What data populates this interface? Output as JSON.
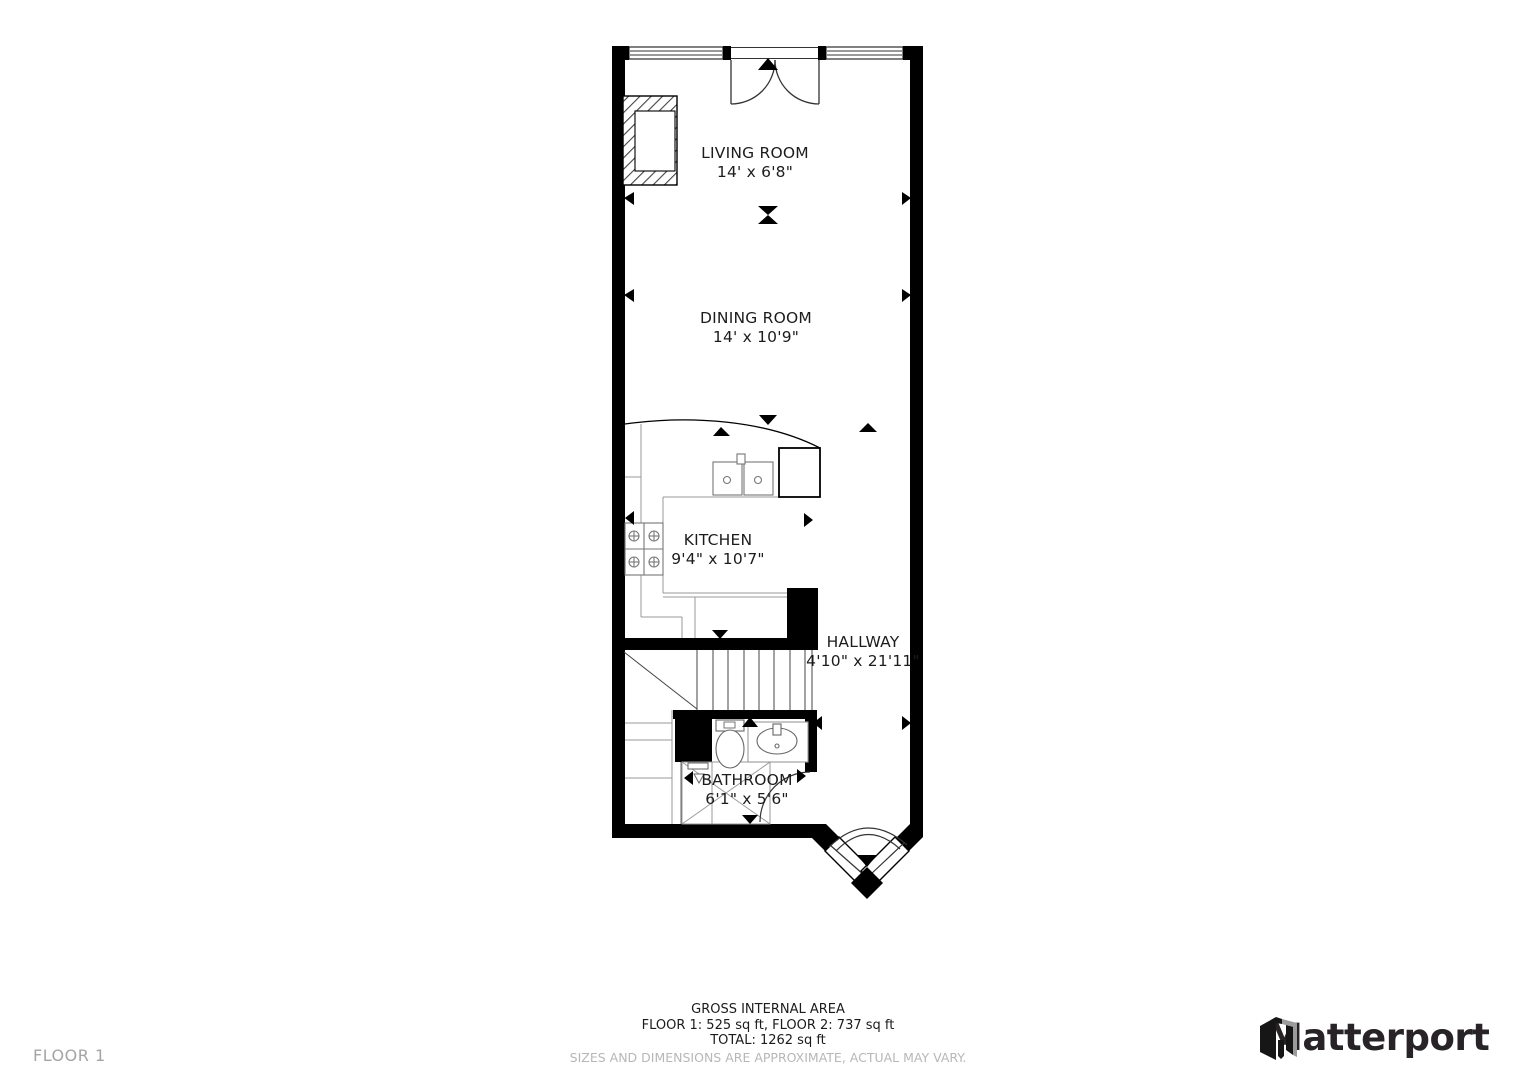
{
  "floorplan": {
    "rooms": [
      {
        "name": "LIVING ROOM",
        "dims": "14' x 6'8\""
      },
      {
        "name": "DINING ROOM",
        "dims": "14' x 10'9\""
      },
      {
        "name": "KITCHEN",
        "dims": "9'4\" x 10'7\""
      },
      {
        "name": "HALLWAY",
        "dims": "4'10\" x 21'11\""
      },
      {
        "name": "BATHROOM",
        "dims": "6'1\" x 5'6\""
      }
    ]
  },
  "footer": {
    "area_title": "GROSS INTERNAL AREA",
    "area_floors": "FLOOR 1: 525 sq ft, FLOOR 2: 737 sq ft",
    "area_total": "TOTAL: 1262 sq ft",
    "disclaimer": "SIZES AND DIMENSIONS ARE APPROXIMATE, ACTUAL MAY VARY."
  },
  "floor_label": "FLOOR 1",
  "brand": {
    "name": "Matterport"
  },
  "colors": {
    "wall": "#000000",
    "text": "#1c1c1c",
    "muted_text": "#b7b7b7",
    "floor_label": "#a4a4a4",
    "brand_text": "#272327",
    "brand_gray": "#9b9b9b"
  }
}
